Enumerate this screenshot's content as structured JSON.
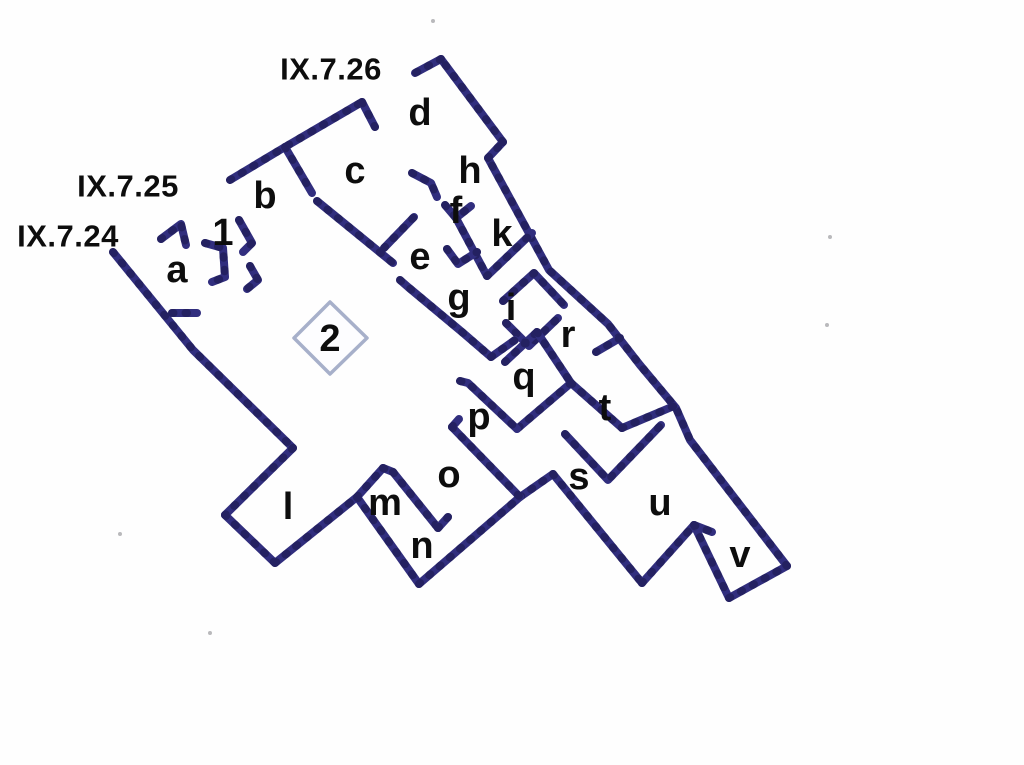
{
  "diagram": {
    "type": "floor-plan",
    "subject": "Pompeii insula plan IX.7.24-26",
    "colors": {
      "wall": "#312e7e",
      "wall_bead": "#1f1d55",
      "impluvium_outline": "#a7b0ca",
      "label": "#0d0d0d",
      "background": "#fefefe"
    },
    "entrance_labels": [
      {
        "text": "IX.7.26",
        "x": 331,
        "y": 69
      },
      {
        "text": "IX.7.25",
        "x": 128,
        "y": 186
      },
      {
        "text": "IX.7.24",
        "x": 68,
        "y": 236
      }
    ],
    "room_labels": [
      {
        "text": "a",
        "x": 177,
        "y": 270
      },
      {
        "text": "b",
        "x": 265,
        "y": 196
      },
      {
        "text": "c",
        "x": 355,
        "y": 171
      },
      {
        "text": "d",
        "x": 420,
        "y": 113
      },
      {
        "text": "e",
        "x": 420,
        "y": 257
      },
      {
        "text": "f",
        "x": 456,
        "y": 211
      },
      {
        "text": "g",
        "x": 459,
        "y": 298
      },
      {
        "text": "h",
        "x": 470,
        "y": 171
      },
      {
        "text": "i",
        "x": 511,
        "y": 308
      },
      {
        "text": "k",
        "x": 502,
        "y": 234
      },
      {
        "text": "l",
        "x": 288,
        "y": 507
      },
      {
        "text": "m",
        "x": 385,
        "y": 503
      },
      {
        "text": "n",
        "x": 422,
        "y": 546
      },
      {
        "text": "o",
        "x": 449,
        "y": 475
      },
      {
        "text": "p",
        "x": 479,
        "y": 417
      },
      {
        "text": "q",
        "x": 524,
        "y": 377
      },
      {
        "text": "r",
        "x": 568,
        "y": 335
      },
      {
        "text": "s",
        "x": 579,
        "y": 477
      },
      {
        "text": "t",
        "x": 605,
        "y": 408
      },
      {
        "text": "u",
        "x": 660,
        "y": 503
      },
      {
        "text": "v",
        "x": 740,
        "y": 555
      },
      {
        "text": "1",
        "x": 223,
        "y": 233
      },
      {
        "text": "2",
        "x": 330,
        "y": 339
      }
    ],
    "walls": [
      [
        113,
        252,
        193,
        350,
        293,
        448
      ],
      [
        172,
        313,
        197,
        313
      ],
      [
        293,
        448,
        225,
        515
      ],
      [
        225,
        515,
        275,
        563
      ],
      [
        275,
        563,
        357,
        497
      ],
      [
        357,
        497,
        419,
        584
      ],
      [
        419,
        584,
        520,
        497
      ],
      [
        520,
        497,
        553,
        474
      ],
      [
        553,
        474,
        642,
        583
      ],
      [
        642,
        583,
        694,
        525
      ],
      [
        694,
        525,
        729,
        598
      ],
      [
        729,
        598,
        787,
        566
      ],
      [
        787,
        566,
        690,
        440,
        676,
        408,
        640,
        365,
        608,
        324,
        549,
        270,
        488,
        158
      ],
      [
        488,
        158,
        503,
        142
      ],
      [
        503,
        142,
        441,
        59
      ],
      [
        441,
        59,
        415,
        73
      ],
      [
        230,
        180,
        285,
        147,
        362,
        102
      ],
      [
        362,
        102,
        375,
        127
      ],
      [
        285,
        147,
        312,
        193
      ],
      [
        317,
        201,
        393,
        263
      ],
      [
        239,
        220,
        252,
        243,
        243,
        252
      ],
      [
        250,
        266,
        258,
        280,
        247,
        289
      ],
      [
        205,
        243,
        223,
        248,
        225,
        277,
        212,
        282
      ],
      [
        161,
        239,
        181,
        224,
        186,
        245
      ],
      [
        412,
        173,
        431,
        183,
        437,
        197
      ],
      [
        445,
        205,
        456,
        218,
        471,
        206
      ],
      [
        456,
        218,
        487,
        276
      ],
      [
        447,
        249,
        458,
        264,
        477,
        252
      ],
      [
        487,
        276,
        532,
        233
      ],
      [
        503,
        301,
        534,
        273,
        564,
        305
      ],
      [
        506,
        323,
        529,
        346,
        558,
        318
      ],
      [
        384,
        248,
        414,
        217
      ],
      [
        400,
        280,
        408,
        287,
        462,
        332,
        491,
        357
      ],
      [
        491,
        357,
        515,
        340
      ],
      [
        505,
        362,
        537,
        332
      ],
      [
        537,
        332,
        571,
        383
      ],
      [
        571,
        383,
        517,
        429
      ],
      [
        460,
        381,
        468,
        383,
        517,
        429
      ],
      [
        620,
        338,
        596,
        352
      ],
      [
        571,
        383,
        622,
        428
      ],
      [
        622,
        428,
        674,
        406
      ],
      [
        565,
        434,
        608,
        480,
        661,
        425
      ],
      [
        694,
        525,
        712,
        532
      ],
      [
        357,
        497,
        383,
        468
      ],
      [
        383,
        468,
        393,
        472
      ],
      [
        393,
        472,
        438,
        528
      ],
      [
        438,
        528,
        448,
        517
      ],
      [
        452,
        427,
        459,
        419
      ],
      [
        452,
        427,
        520,
        497
      ]
    ],
    "impluvium": [
      330,
      302,
      367,
      338,
      330,
      374,
      294,
      338
    ],
    "specks": [
      {
        "x": 433,
        "y": 21
      },
      {
        "x": 830,
        "y": 237
      },
      {
        "x": 827,
        "y": 325
      },
      {
        "x": 120,
        "y": 534
      },
      {
        "x": 210,
        "y": 633
      }
    ]
  }
}
